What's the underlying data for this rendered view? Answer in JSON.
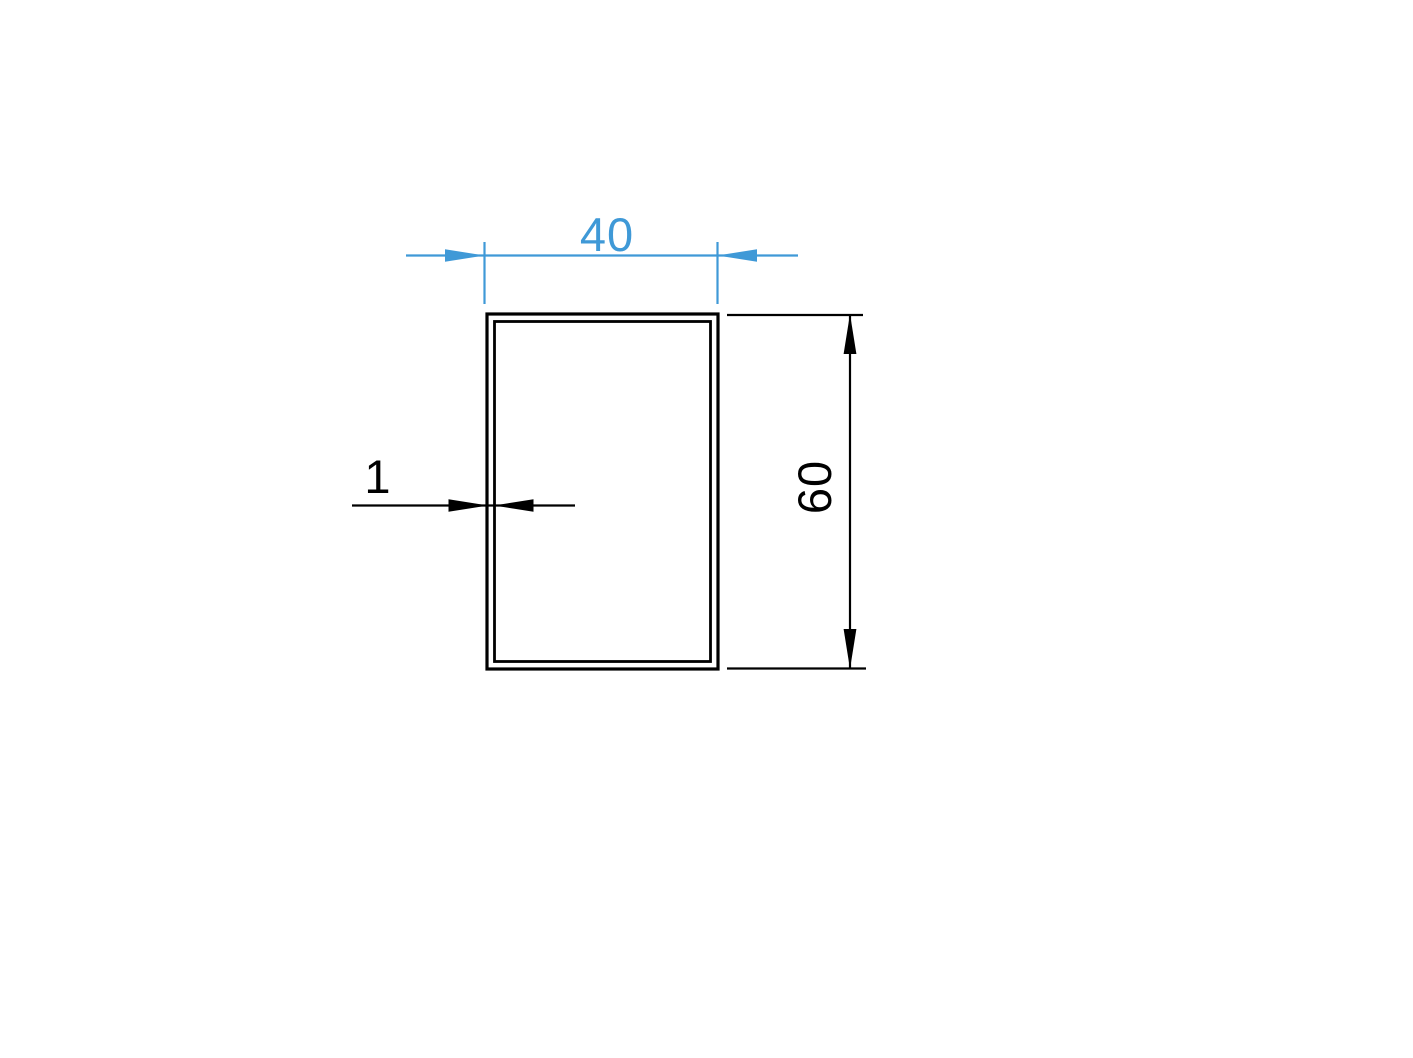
{
  "drawing": {
    "labels": {
      "width": "40",
      "height": "60",
      "wall_thickness": "1"
    },
    "colors": {
      "accent_blue": "#3f99d7",
      "ink_black": "#000000",
      "background": "#ffffff"
    }
  }
}
